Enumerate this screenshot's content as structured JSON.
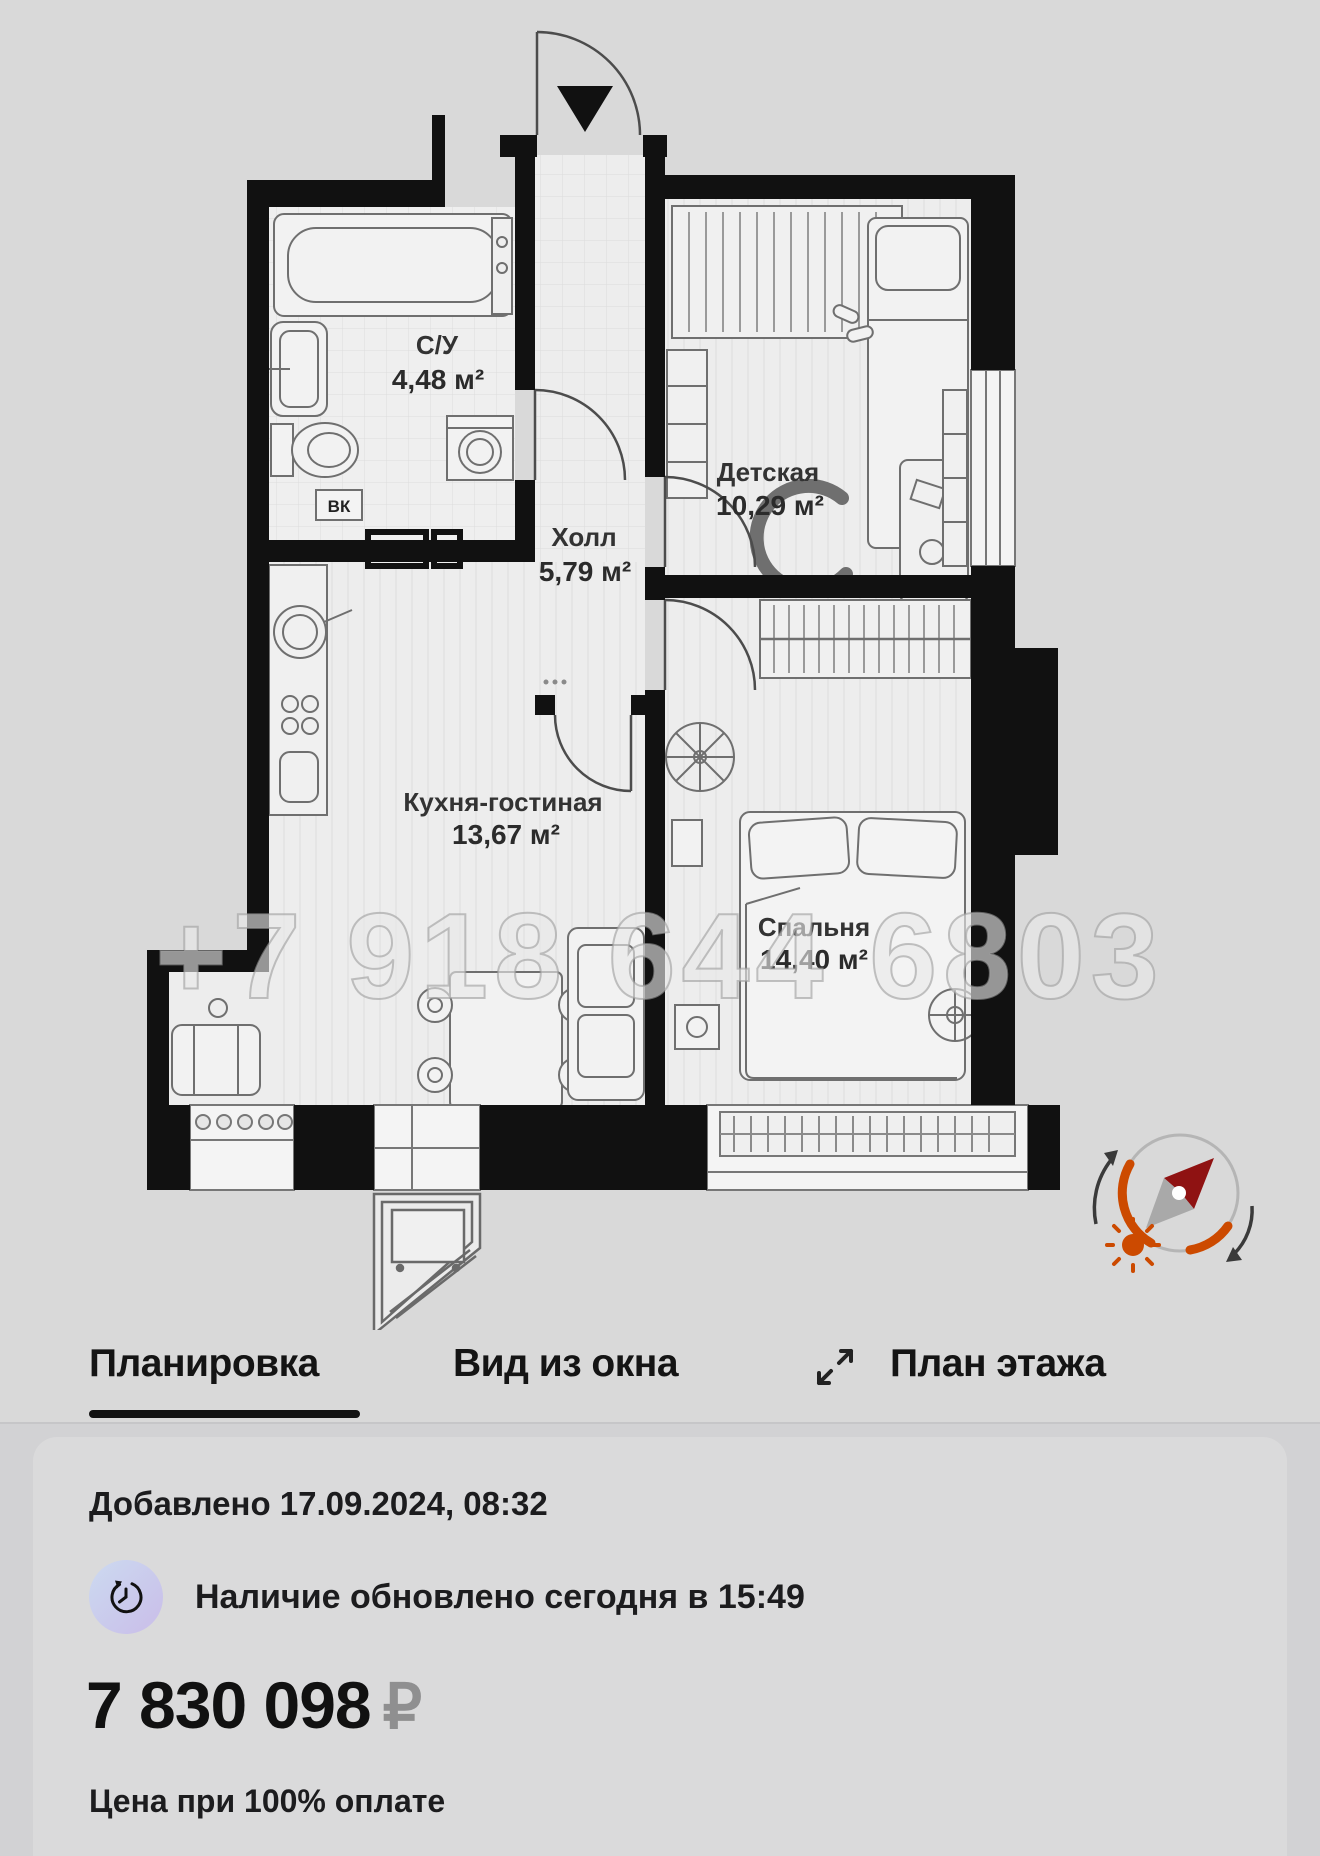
{
  "floor_plan": {
    "rooms": [
      {
        "name": "С/У",
        "area": "4,48 м²"
      },
      {
        "name": "Холл",
        "area": "5,79 м²"
      },
      {
        "name": "Детская",
        "area": "10,29 м²"
      },
      {
        "name": "Кухня-гостиная",
        "area": "13,67 м²"
      },
      {
        "name": "Спальня",
        "area": "14,40 м²"
      }
    ],
    "labels": {
      "water_meter": "ВК"
    },
    "watermark": "+7 918 644 6803"
  },
  "tabs": {
    "items": [
      {
        "label": "Планировка",
        "active": true
      },
      {
        "label": "Вид из окна",
        "active": false
      },
      {
        "label": "План этажа",
        "active": false,
        "icon": "expand-icon"
      }
    ]
  },
  "listing": {
    "added": "Добавлено 17.09.2024, 08:32",
    "availability": "Наличие обновлено сегодня в 15:49",
    "price": "7 830 098",
    "currency": "₽",
    "price_note": "Цена при 100% оплате"
  },
  "colors": {
    "background": "#d9d9d9",
    "walls": "#111111",
    "accent_arc": "#cc4a00",
    "needle_red": "#8f1212",
    "price_currency": "#8f8f90",
    "icon_gradient_start": "#ccdaf0",
    "icon_gradient_end": "#c9bde9"
  }
}
